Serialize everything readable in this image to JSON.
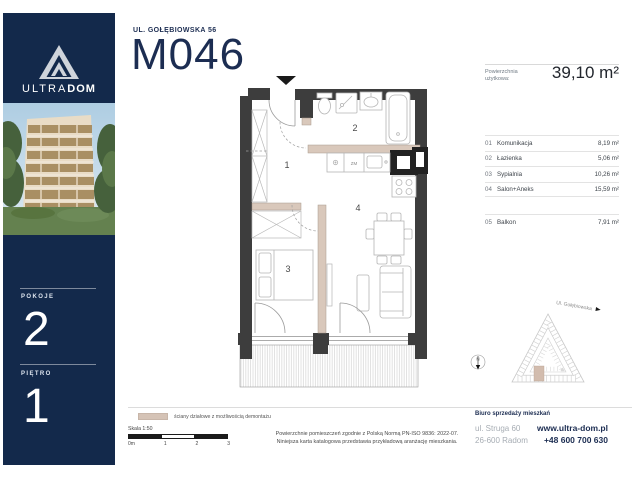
{
  "header": {
    "street": "UL. GOŁĘBIOWSKA 56",
    "unit_code": "M046"
  },
  "sidebar": {
    "logo_light": "ULTRA",
    "logo_bold": "DOM",
    "rooms_label": "POKOJE",
    "rooms_value": "2",
    "floor_label": "PIĘTRO",
    "floor_value": "1"
  },
  "summary": {
    "label_line1": "Powierzchnia",
    "label_line2": "użytkowa:",
    "value": "39,10 m²"
  },
  "rooms": [
    {
      "num": "01",
      "name": "Komunikacja",
      "area": "8,19 m²"
    },
    {
      "num": "02",
      "name": "Łazienka",
      "area": "5,06 m²"
    },
    {
      "num": "03",
      "name": "Sypialnia",
      "area": "10,26 m²"
    },
    {
      "num": "04",
      "name": "Salon+Aneks",
      "area": "15,59 m²"
    },
    {
      "num": "05",
      "name": "Balkon",
      "area": "7,91 m²"
    }
  ],
  "plan": {
    "room1": "1",
    "room2": "2",
    "room3": "3",
    "room4": "4",
    "dishwasher_label": "ZM"
  },
  "legend": {
    "partition_label": "ściany działowe z możliwością demontażu",
    "scale_label": "Skala 1:50",
    "ticks": [
      "0m",
      "1",
      "2",
      "3"
    ]
  },
  "notes": {
    "line1": "Powierzchnie pomieszczeń zgodnie z Polską Normą PN-ISO 9836: 2022-07.",
    "line2": "Niniejsza karta katalogowa przedstawia przykładową aranżację mieszkania."
  },
  "contact": {
    "heading": "Biuro sprzedaży mieszkań",
    "address1": "ul. Struga 60",
    "address2": "26-600 Radom",
    "website": "www.ultra-dom.pl",
    "phone": "+48 600 700 630"
  },
  "sitemap": {
    "street_label": "Ul. Gołębiowska",
    "compass": "N"
  },
  "colors": {
    "navy": "#13294b",
    "wall": "#3d3d3d",
    "partition": "#d9c8bb",
    "highlight": "#d2bcae"
  }
}
